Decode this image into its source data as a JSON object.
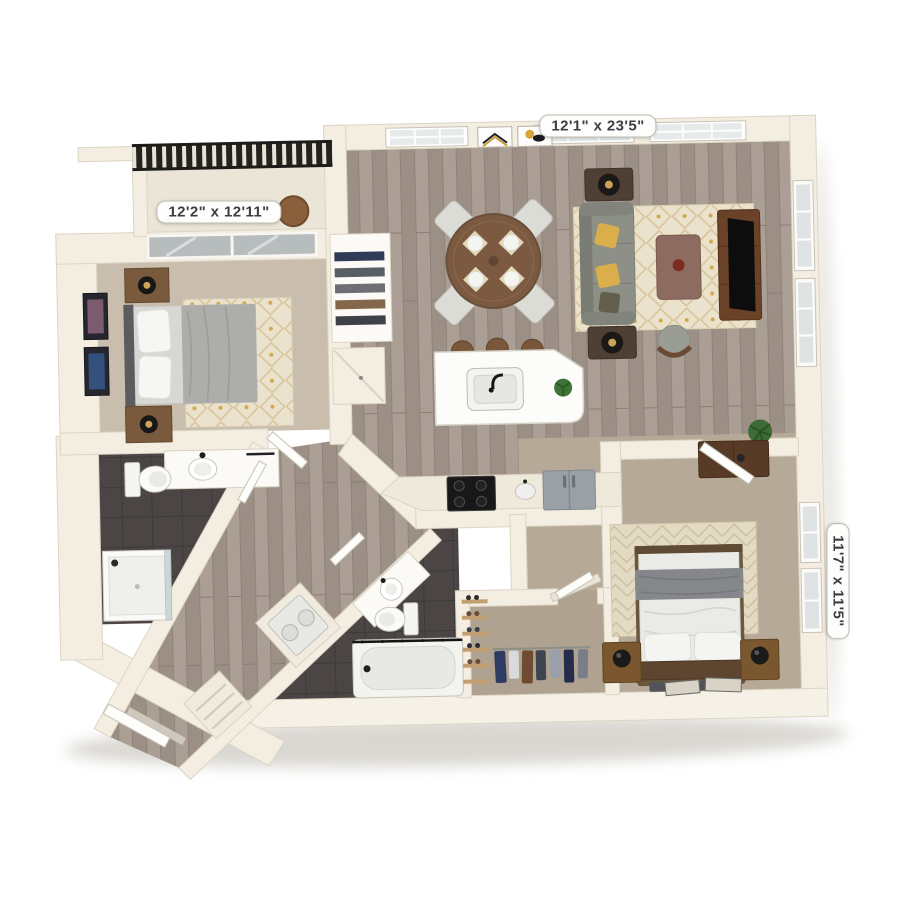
{
  "scene": {
    "description": "3D top-down rendering of a two-bedroom two-bath apartment floor plan on a white background",
    "background": "#ffffff"
  },
  "areas": {
    "living_dining_kitchen": {
      "label": "12'1\" x 23'5\"",
      "floor": "hardwood",
      "features": [
        "round dining table with four chairs and place settings",
        "gray sofa with yellow pillows",
        "two end tables with black lamps",
        "patterned area rug",
        "coffee table",
        "accent chair",
        "media console with TV",
        "kitchen island with sink, plant and bar stools",
        "range",
        "kitchen sink",
        "refrigerator",
        "transom windows",
        "two framed artworks",
        "floor plant"
      ]
    },
    "bedroom_1": {
      "label": "12'2\" x 12'11\"",
      "floor": "carpet",
      "features": [
        "bed with gray duvet",
        "two nightstands with lamps",
        "two framed artworks",
        "area rug",
        "sliding glass door to balcony",
        "shelved closet with clothes"
      ]
    },
    "bedroom_2": {
      "label": "11'7\" x 11'5\"",
      "floor": "carpet",
      "features": [
        "bed with gray throw blanket",
        "two nightstands with black lamps",
        "dresser",
        "diamond pattern rug",
        "two picture frames on floor",
        "two windows"
      ]
    },
    "balcony": {
      "features": [
        "dark metal railing",
        "round bistro table"
      ]
    },
    "bathroom_1": {
      "floor": "dark tile",
      "features": [
        "vanity with sink",
        "toilet",
        "walk-in shower with glass panel"
      ]
    },
    "bathroom_2": {
      "floor": "dark tile",
      "features": [
        "vanity with sink",
        "toilet",
        "bathtub with curtain rod"
      ]
    },
    "walk_in_closet": {
      "floor": "carpet",
      "features": [
        "hanging rod with clothes",
        "shoe shelves"
      ]
    },
    "entry_hallway": {
      "floor": "hardwood",
      "features": [
        "open entry door",
        "laundry closet with washer and dryer",
        "storage closets"
      ]
    }
  },
  "palette": {
    "wall": "#f4eee2",
    "wall_edge": "#dcd5c3",
    "hardwood": "#a2968d",
    "carpet_bedroom1": "#c9bead",
    "carpet_bedroom2": "#b6a998",
    "dark_tile": "#4b4645",
    "sofa_gray": "#8d9087",
    "accent_yellow": "#d9ae4b",
    "furniture_wood": "#7a5a3c",
    "railing_dark": "#24221e",
    "label_text": "#3b3e44"
  }
}
